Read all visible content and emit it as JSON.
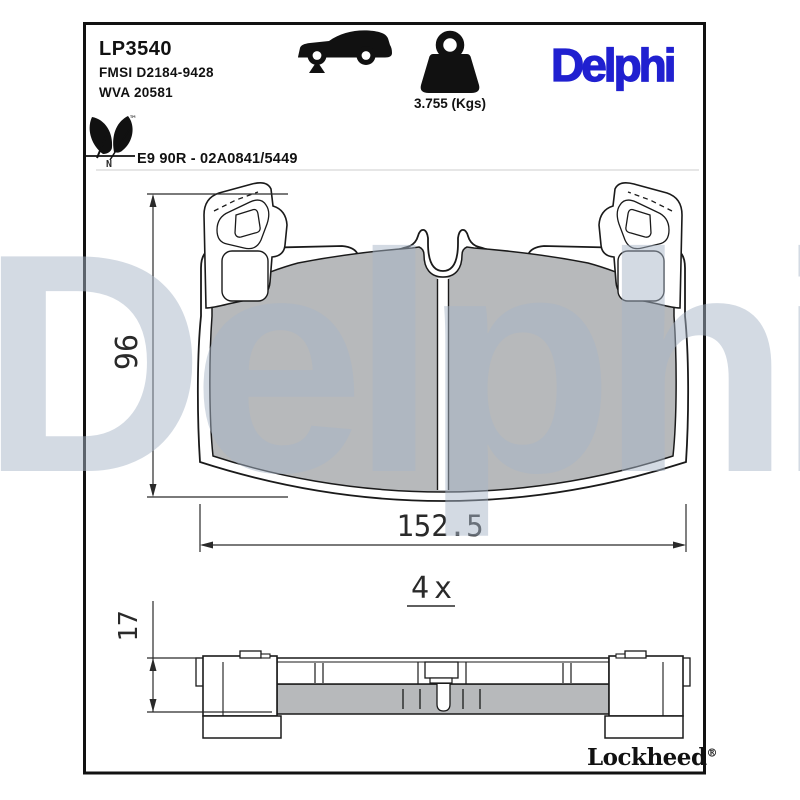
{
  "header": {
    "part_number": "LP3540",
    "fmsi_ref": "FMSI D2184-9428",
    "wva_ref": "WVA 20581",
    "weight": "3.755 (Kgs)",
    "brand": "Delphi",
    "homologation": "E9 90R - 02A0841/5449",
    "eco_tm": "™",
    "eco_n": "N"
  },
  "drawing": {
    "height_mm": "96",
    "width_mm": "152.5",
    "quantity": "4x",
    "thickness_mm": "17"
  },
  "footer": {
    "brand": "Lockheed",
    "registered": "®"
  },
  "watermark": "Delphi",
  "colors": {
    "brand_blue": "#2020d0",
    "pad_gray": "#b7b9bb",
    "line": "#1a1a1a",
    "watermark": "rgba(168,182,200,0.5)"
  }
}
